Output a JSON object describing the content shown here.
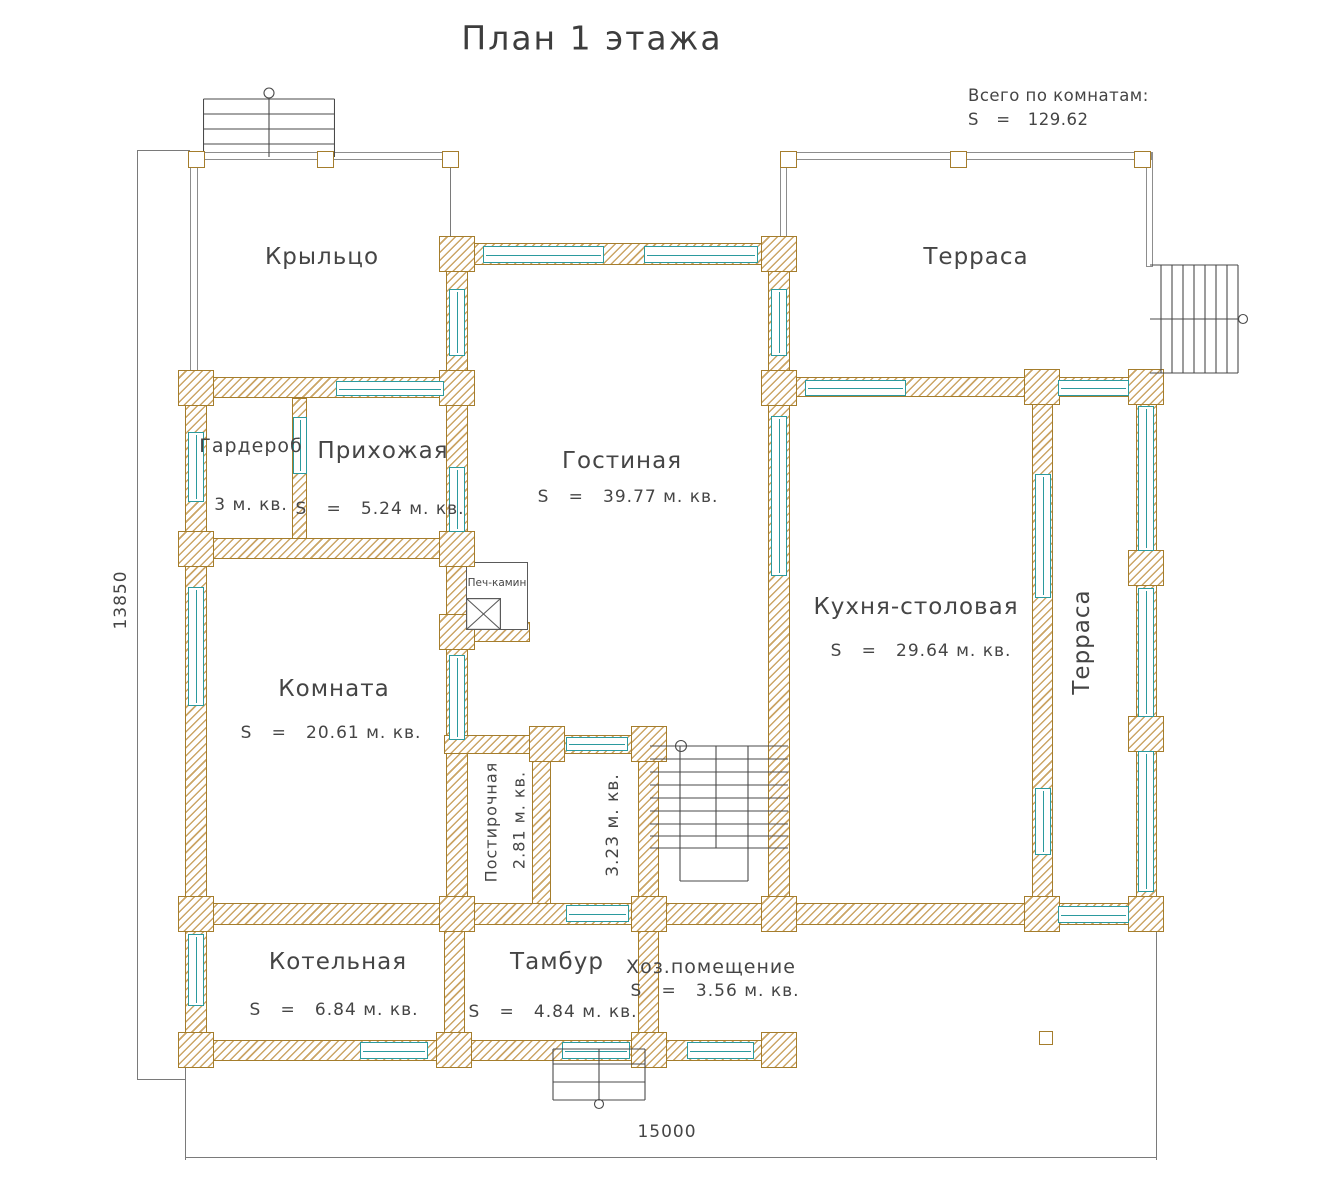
{
  "title": "План 1 этажа",
  "summary": {
    "heading": "Всего по комнатам:",
    "total_line": "S   =   129.62",
    "total_area": "129.62"
  },
  "dimensions": {
    "overall_width_mm": "15000",
    "overall_height_mm": "13850"
  },
  "rooms": {
    "porch": {
      "name": "Крыльцо"
    },
    "terrace_top": {
      "name": "Терраса"
    },
    "wardrobe": {
      "name": "Гардероб",
      "area_line": "3 м. кв."
    },
    "hallway": {
      "name": "Прихожая",
      "area_line": "S   =   5.24 м. кв."
    },
    "living": {
      "name": "Гостиная",
      "area_line": "S   =   39.77 м. кв."
    },
    "kitchen_dining": {
      "name": "Кухня-столовая",
      "area_line": "S   =   29.64 м. кв."
    },
    "terrace_right": {
      "name": "Терраса"
    },
    "room": {
      "name": "Комната",
      "area_line": "S   =   20.61 м. кв."
    },
    "fireplace": {
      "name": "Печ-камин"
    },
    "laundry": {
      "name": "Постирочная",
      "area_line": "2.81 м. кв."
    },
    "stair_room": {
      "area_line": "3.23 м. кв."
    },
    "boiler": {
      "name": "Котельная",
      "area_line": "S   =   6.84 м. кв."
    },
    "vestibule": {
      "name": "Тамбур",
      "area_line": "S   =   4.84 м. кв."
    },
    "utility": {
      "name": "Хоз.помещение",
      "area_line": "S   =   3.56 м. кв."
    }
  },
  "colors": {
    "wall_outline": "#a57d2c",
    "wall_hatch": "#cba566",
    "window": "#2b9a9e",
    "drawing_line": "#5a5a5a",
    "text": "#454545"
  }
}
